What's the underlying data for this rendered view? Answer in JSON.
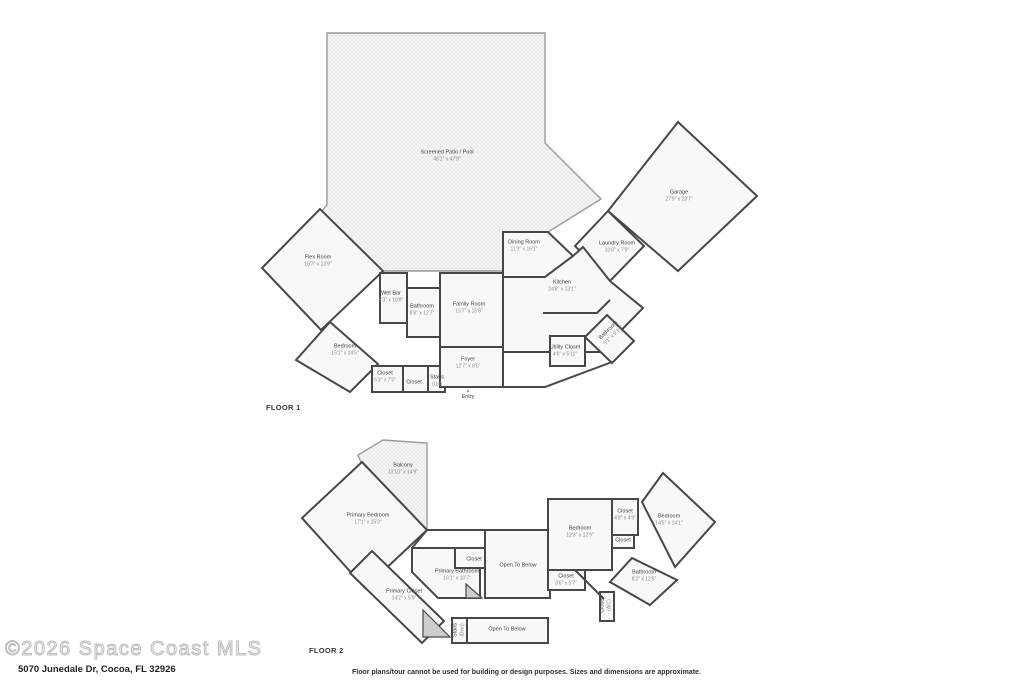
{
  "floors": [
    {
      "label": "FLOOR 1",
      "rooms": [
        {
          "name": "Screened Patio / Pool",
          "dims": "46'1\" x 47'9\"",
          "x": 447,
          "y": 156
        },
        {
          "name": "Garage",
          "dims": "27'9\" x 23'7\"",
          "x": 679,
          "y": 196
        },
        {
          "name": "Laundry Room",
          "dims": "10'8\" x 7'9\"",
          "x": 617,
          "y": 247
        },
        {
          "name": "Dining Room",
          "dims": "11'3\" x 16'1\"",
          "x": 524,
          "y": 246
        },
        {
          "name": "Kitchen",
          "dims": "24'8\" x 13'1\"",
          "x": 562,
          "y": 286
        },
        {
          "name": "Flex Room",
          "dims": "16'7\" x 13'9\"",
          "x": 318,
          "y": 261
        },
        {
          "name": "Wet Bar",
          "dims": "5'3\" x 10'8\"",
          "x": 391,
          "y": 297
        },
        {
          "name": "Bathroom",
          "dims": "8'8\" x 12'7\"",
          "x": 422,
          "y": 310
        },
        {
          "name": "Family Room",
          "dims": "15'7\" x 15'8\"",
          "x": 469,
          "y": 308
        },
        {
          "name": "Bedroom",
          "dims": "15'1\" x 14'5\"",
          "x": 345,
          "y": 350
        },
        {
          "name": "Closet",
          "dims": "5'3\" x 7'5\"",
          "x": 385,
          "y": 377
        },
        {
          "name": "Closet",
          "dims": "",
          "x": 414,
          "y": 383
        },
        {
          "name": "Stairs",
          "dims": "(Up)",
          "x": 437,
          "y": 381
        },
        {
          "name": "Foyer",
          "dims": "12'7\" x 8'5\"",
          "x": 468,
          "y": 363
        },
        {
          "name": "Utility Closet",
          "dims": "4'6\" x 5'11\"",
          "x": 565,
          "y": 351
        },
        {
          "name": "Bathroom",
          "dims": "5'1\" x 9'10\"",
          "x": 611,
          "y": 333,
          "rotate": -45
        },
        {
          "name": "Entry",
          "dims": "",
          "x": 468,
          "y": 395,
          "marker": "▲"
        }
      ]
    },
    {
      "label": "FLOOR 2",
      "rooms": [
        {
          "name": "Balcony",
          "dims": "13'10\" x 14'9\"",
          "x": 403,
          "y": 469
        },
        {
          "name": "Primary Bedroom",
          "dims": "17'1\" x 15'3\"",
          "x": 368,
          "y": 519
        },
        {
          "name": "Primary Bathroom",
          "dims": "16'1\" x 10'7\"",
          "x": 457,
          "y": 575
        },
        {
          "name": "Closet",
          "dims": "",
          "x": 474,
          "y": 560
        },
        {
          "name": "Open To Below",
          "dims": "",
          "x": 518,
          "y": 566
        },
        {
          "name": "Bedroom",
          "dims": "12'3\" x 12'9\"",
          "x": 580,
          "y": 532
        },
        {
          "name": "Closet",
          "dims": "4'9\" x 4'9\"",
          "x": 625,
          "y": 515
        },
        {
          "name": "Closet",
          "dims": "",
          "x": 623,
          "y": 541
        },
        {
          "name": "Bedroom",
          "dims": "14'5\" x 14'1\"",
          "x": 669,
          "y": 520
        },
        {
          "name": "Bathroom",
          "dims": "8'2\" x 12'5\"",
          "x": 644,
          "y": 576
        },
        {
          "name": "Closet",
          "dims": "3'6\" x 5'7\"",
          "x": 566,
          "y": 580
        },
        {
          "name": "Primary Closet",
          "dims": "14'2\" x 5'9\"",
          "x": 404,
          "y": 595
        },
        {
          "name": "Stairs",
          "dims": "(Dwn)",
          "x": 459,
          "y": 630,
          "rotate": -90
        },
        {
          "name": "Open To Below",
          "dims": "",
          "x": 507,
          "y": 630
        },
        {
          "name": "Closet",
          "dims": "(A/C)",
          "x": 606,
          "y": 605,
          "rotate": -90
        }
      ]
    }
  ],
  "footer": {
    "watermark": "©2026 Space Coast MLS",
    "address": "5070 Junedale Dr, Cocoa, FL 32926",
    "disclaimer": "Floor plans/tour cannot be used for building or design purposes. Sizes and dimensions are approximate."
  },
  "colors": {
    "wall": "#474747",
    "screen_wall": "#9b9b9b",
    "room_fill": "#f8f8f8",
    "shaded_fill": "#cdcdcd",
    "label_text": "#3f3f3f",
    "dims_text": "#8a8a8a",
    "watermark_outline": "#bdbdbd",
    "address_text": "#1f1f1f"
  }
}
